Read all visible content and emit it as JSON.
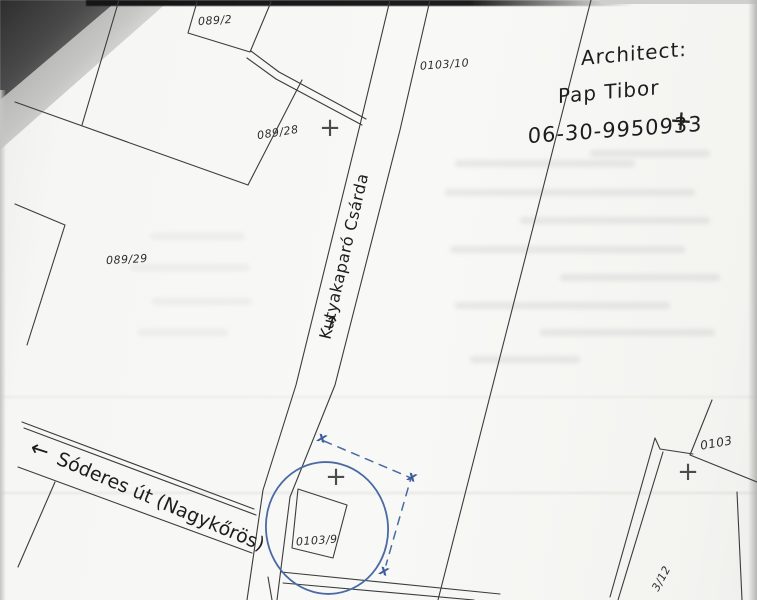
{
  "map": {
    "parcel_labels": [
      {
        "text": "089/2"
      },
      {
        "text": "089/28"
      },
      {
        "text": "089/29"
      },
      {
        "text": "0103/10"
      },
      {
        "text": "0103/9"
      },
      {
        "text": "0103"
      },
      {
        "text": "3/12"
      }
    ],
    "street_labels": {
      "vertical_road_arrow": "→",
      "vertical_road": "Kutyakaparó Csárda",
      "bottom_road_arrow": "←",
      "bottom_road": "Sóderes út (Nagykőrös)"
    },
    "handwritten_note": {
      "line1": "Architect:",
      "line2": "Pap Tibor",
      "line3": "06-30-9950933"
    },
    "marks": {
      "survey_cross": "+",
      "boundary_x": "x"
    },
    "colors": {
      "ink": "#3c3c3c",
      "pen_blue": "#4a6aa4",
      "paper": "#f7f7f5"
    }
  }
}
